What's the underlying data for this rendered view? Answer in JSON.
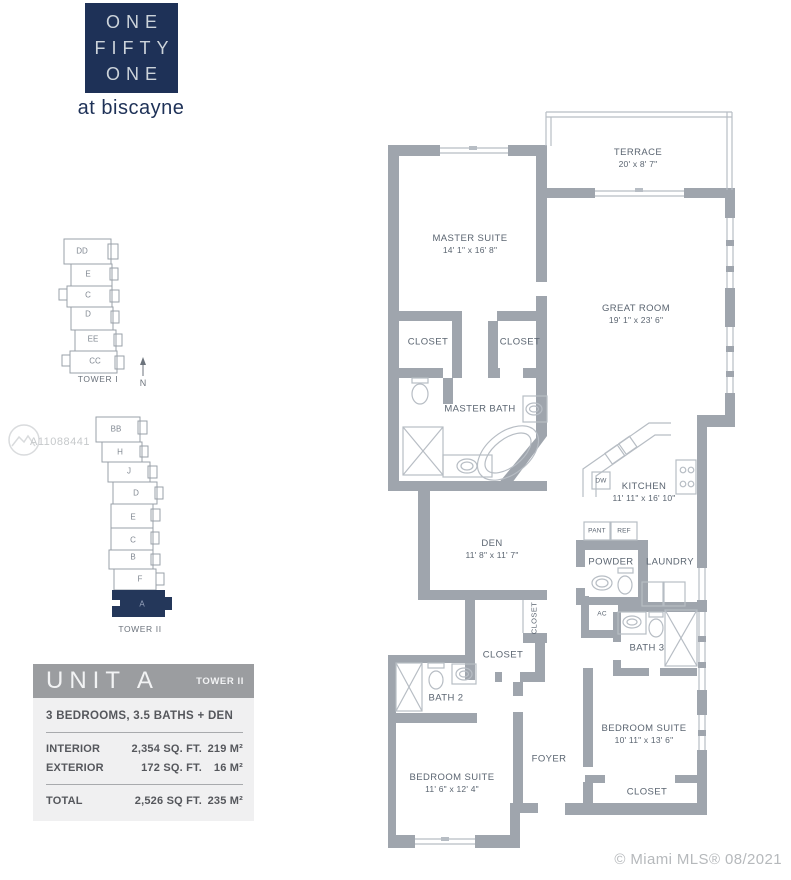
{
  "colors": {
    "brand_navy": "#1e3157",
    "unit_highlight_navy": "#24375a",
    "wall_gray": "#9fa5ad",
    "plan_label_blue_gray": "#5b6571",
    "card_header_gray": "#9b9da0",
    "card_body_gray": "#f0f0f1"
  },
  "logo": {
    "line1": "ONE",
    "line2": "FIFTY",
    "line3": "ONE",
    "tagline": "at biscayne"
  },
  "towers": {
    "north_label": "N",
    "tower1": {
      "caption": "TOWER I",
      "units": [
        "DD",
        "E",
        "C",
        "D",
        "EE",
        "CC"
      ]
    },
    "tower2": {
      "caption": "TOWER II",
      "units": [
        "BB",
        "H",
        "J",
        "D",
        "E",
        "C",
        "B",
        "F"
      ],
      "highlighted_unit": "A"
    }
  },
  "watermark": "A11088441",
  "info_card": {
    "unit_title": "UNIT A",
    "tower_label": "TOWER II",
    "summary": "3 BEDROOMS, 3.5 BATHS + DEN",
    "rows": [
      {
        "label": "INTERIOR",
        "sqft": "2,354 SQ. FT.",
        "m2": "219 M²"
      },
      {
        "label": "EXTERIOR",
        "sqft": "172 SQ. FT.",
        "m2": "16 M²"
      }
    ],
    "total": {
      "label": "TOTAL",
      "sqft": "2,526 SQ FT.",
      "m2": "235 M²"
    }
  },
  "floor_plan": {
    "rooms": [
      {
        "name": "TERRACE",
        "dims": "20' x 8' 7\""
      },
      {
        "name": "MASTER SUITE",
        "dims": "14' 1\" x 16' 8\""
      },
      {
        "name": "GREAT ROOM",
        "dims": "19' 1\" x 23' 6\""
      },
      {
        "name": "CLOSET"
      },
      {
        "name": "CLOSET"
      },
      {
        "name": "MASTER BATH"
      },
      {
        "name": "KITCHEN",
        "dims": "11' 11\" x 16' 10\""
      },
      {
        "name": "DEN",
        "dims": "11' 8\" x 11' 7\""
      },
      {
        "name": "POWDER"
      },
      {
        "name": "LAUNDRY"
      },
      {
        "name": "CLOSET"
      },
      {
        "name": "CLOSET"
      },
      {
        "name": "BATH 3"
      },
      {
        "name": "BATH 2"
      },
      {
        "name": "BEDROOM SUITE",
        "dims": "10' 11\" x 13' 6\""
      },
      {
        "name": "FOYER"
      },
      {
        "name": "BEDROOM SUITE",
        "dims": "11' 6\" x 12' 4\""
      },
      {
        "name": "CLOSET"
      }
    ],
    "fixtures": {
      "dw": "DW",
      "pant": "PANT",
      "ref": "REF",
      "ac": "AC"
    }
  },
  "footer": "© Miami MLS® 08/2021"
}
